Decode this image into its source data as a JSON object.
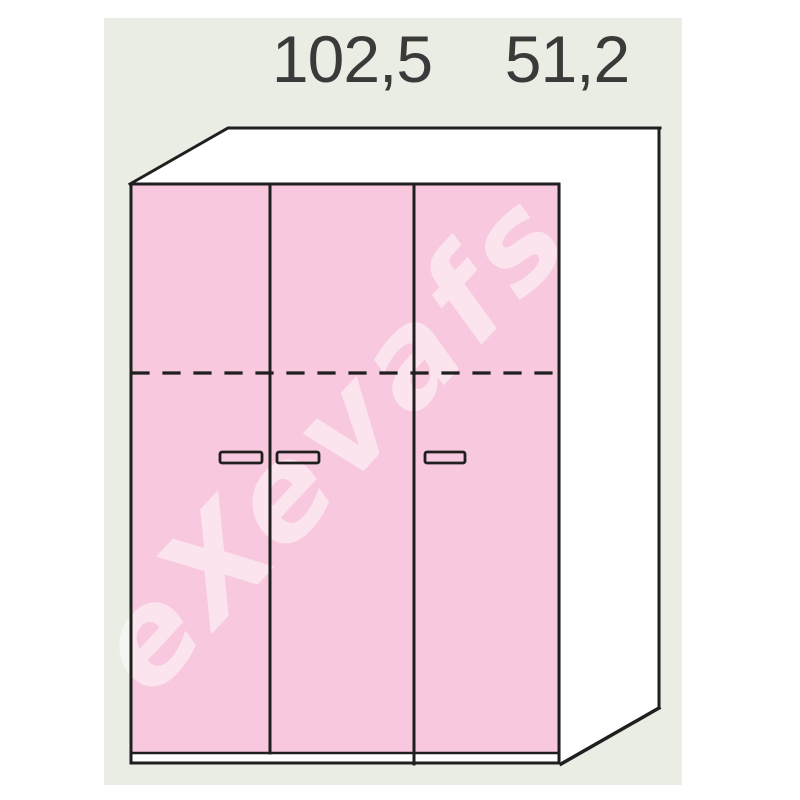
{
  "page": {
    "background_color": "#ffffff",
    "panel_color": "#E9EDE4",
    "outline_color": "#1F1F1F",
    "text_color": "#3A3A3A"
  },
  "dimension_labels": {
    "two_door_module_width": "102,5",
    "single_door_module_width": "51,2"
  },
  "watermark": {
    "text": "eXevafs",
    "fill": "rgba(255,255,255,0.5)"
  },
  "wardrobe": {
    "doors_count": 3,
    "door_color": "#F8C8DE",
    "handle_fill": "#F6D5E5",
    "side_color": "#FFFFFF",
    "top_color": "#FFFFFF"
  }
}
